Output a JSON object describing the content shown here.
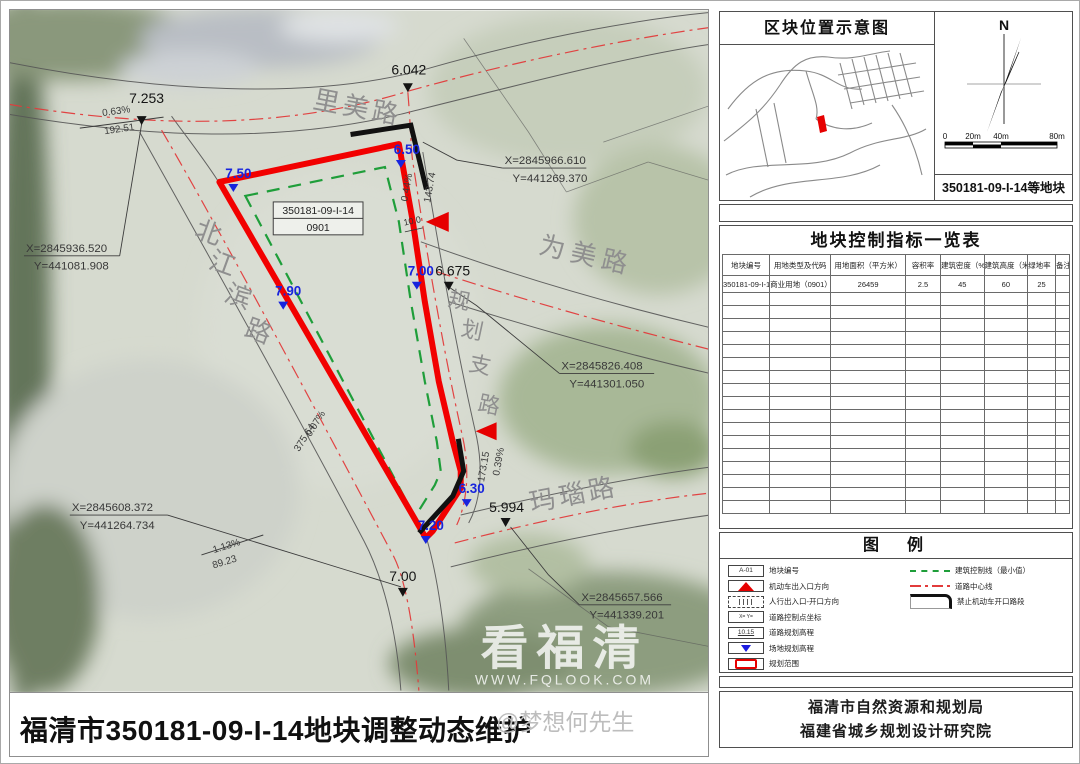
{
  "document": {
    "title": "福清市350181-09-I-14地块调整动态维护",
    "watermark_author": "@梦想何先生"
  },
  "map": {
    "watermark": {
      "main": "看福清",
      "sub": "WWW.FQLOOK.COM"
    },
    "parcel_box": {
      "code": "350181-09-I-14",
      "use_code": "0901"
    },
    "road_names": {
      "limei": "里美路",
      "weimei": "为美路",
      "manao": "玛瑙路",
      "beijiangbin": [
        "北",
        "江",
        "滨",
        "路"
      ],
      "guihua_zhilu": [
        "规",
        "划",
        "支",
        "路"
      ]
    },
    "road_elevations": {
      "e1": "7.253",
      "e2": "6.042",
      "e3": "6.675",
      "e4": "5.994",
      "e5": "7.00"
    },
    "site_elevations": {
      "s1": "7.50",
      "s2": "6.50",
      "s3": "7.90",
      "s4": "7.00",
      "s5": "6.30",
      "s6": "7.20"
    },
    "slopes": {
      "a_grade": "0.63%",
      "a_len": "192.51",
      "b_grade": "0.44%",
      "b_len": "143.74",
      "c_grade": "0.07%",
      "c_len": "375.64",
      "d_grade": "0.39%",
      "d_len": "173.15",
      "e_grade": "1.13%",
      "e_len": "89.23"
    },
    "coords": {
      "c1x": "X=2845966.610",
      "c1y": "Y=441269.370",
      "c2x": "X=2845936.520",
      "c2y": "Y=441081.908",
      "c3x": "X=2845826.408",
      "c3y": "Y=441301.050",
      "c4x": "X=2845608.372",
      "c4y": "Y=441264.734",
      "c5x": "X=2845657.566",
      "c5y": "Y=441339.201"
    },
    "dimension": "10.0"
  },
  "panel": {
    "location_title": "区块位置示意图",
    "north": "N",
    "scale": {
      "t0": "0",
      "t1": "20m",
      "t2": "40m",
      "t3": "80m"
    },
    "block_label": "350181-09-I-14等地块",
    "table_title": "地块控制指标一览表",
    "table_headers": [
      "地块编号",
      "用地类型及代码",
      "用地面积（平方米）",
      "容积率",
      "建筑密度（%）",
      "建筑高度（米）",
      "绿地率（%）",
      "备注"
    ],
    "table_row": [
      "350181-09-I-14",
      "商业用地（0901）",
      "26459",
      "2.5",
      "45",
      "60",
      "25",
      ""
    ],
    "table_empty_rows": 17,
    "legend_title": "图　例",
    "legend": {
      "items_left": [
        {
          "label": "地块编号",
          "icon_text": "A-01"
        },
        {
          "label": "机动车出入口方向"
        },
        {
          "label": "人行出入口-开口方向"
        },
        {
          "label": "道路控制点坐标",
          "icon_text": "X= Y="
        },
        {
          "label": "道路规划高程",
          "icon_text": "10.15"
        },
        {
          "label": "场地规划高程"
        },
        {
          "label": "规划范围"
        }
      ],
      "items_right": [
        {
          "label": "建筑控制线（最小值）"
        },
        {
          "label": "道路中心线"
        },
        {
          "label": "禁止机动车开口路段"
        }
      ]
    },
    "org1": "福清市自然资源和规划局",
    "org2": "福建省城乡规划设计研究院"
  },
  "colors": {
    "parcel_red": "#f20000",
    "control_green": "#1f9e3a",
    "elevation_blue": "#1724dd"
  }
}
